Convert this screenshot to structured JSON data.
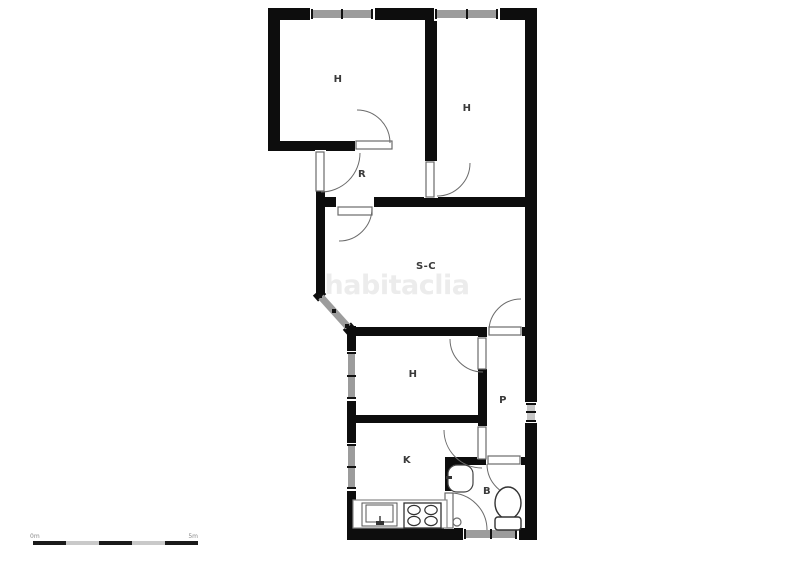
{
  "plan": {
    "title": "apartment-floor-plan",
    "watermark": "habitaclia",
    "rooms": [
      {
        "id": "bedroom-1",
        "label": "H"
      },
      {
        "id": "bedroom-2",
        "label": "H"
      },
      {
        "id": "hall",
        "label": "R"
      },
      {
        "id": "living-dining",
        "label": "S-C"
      },
      {
        "id": "bedroom-3",
        "label": "H"
      },
      {
        "id": "corridor",
        "label": "P"
      },
      {
        "id": "kitchen",
        "label": "K"
      },
      {
        "id": "bathroom",
        "label": "B"
      }
    ],
    "fixtures": [
      "kitchen-sink",
      "stove-4-burners",
      "washbasin",
      "toilet"
    ],
    "scale_bar": {
      "start_label": "0m",
      "end_label": "5m",
      "segments": 5
    },
    "colors": {
      "wall": "#0d0d0d",
      "window": "#9c9c9c",
      "door": "#6b6b6b",
      "label": "#3a3a3a",
      "watermark": "#ececec",
      "scale_alt": "#c9c9c9"
    }
  }
}
